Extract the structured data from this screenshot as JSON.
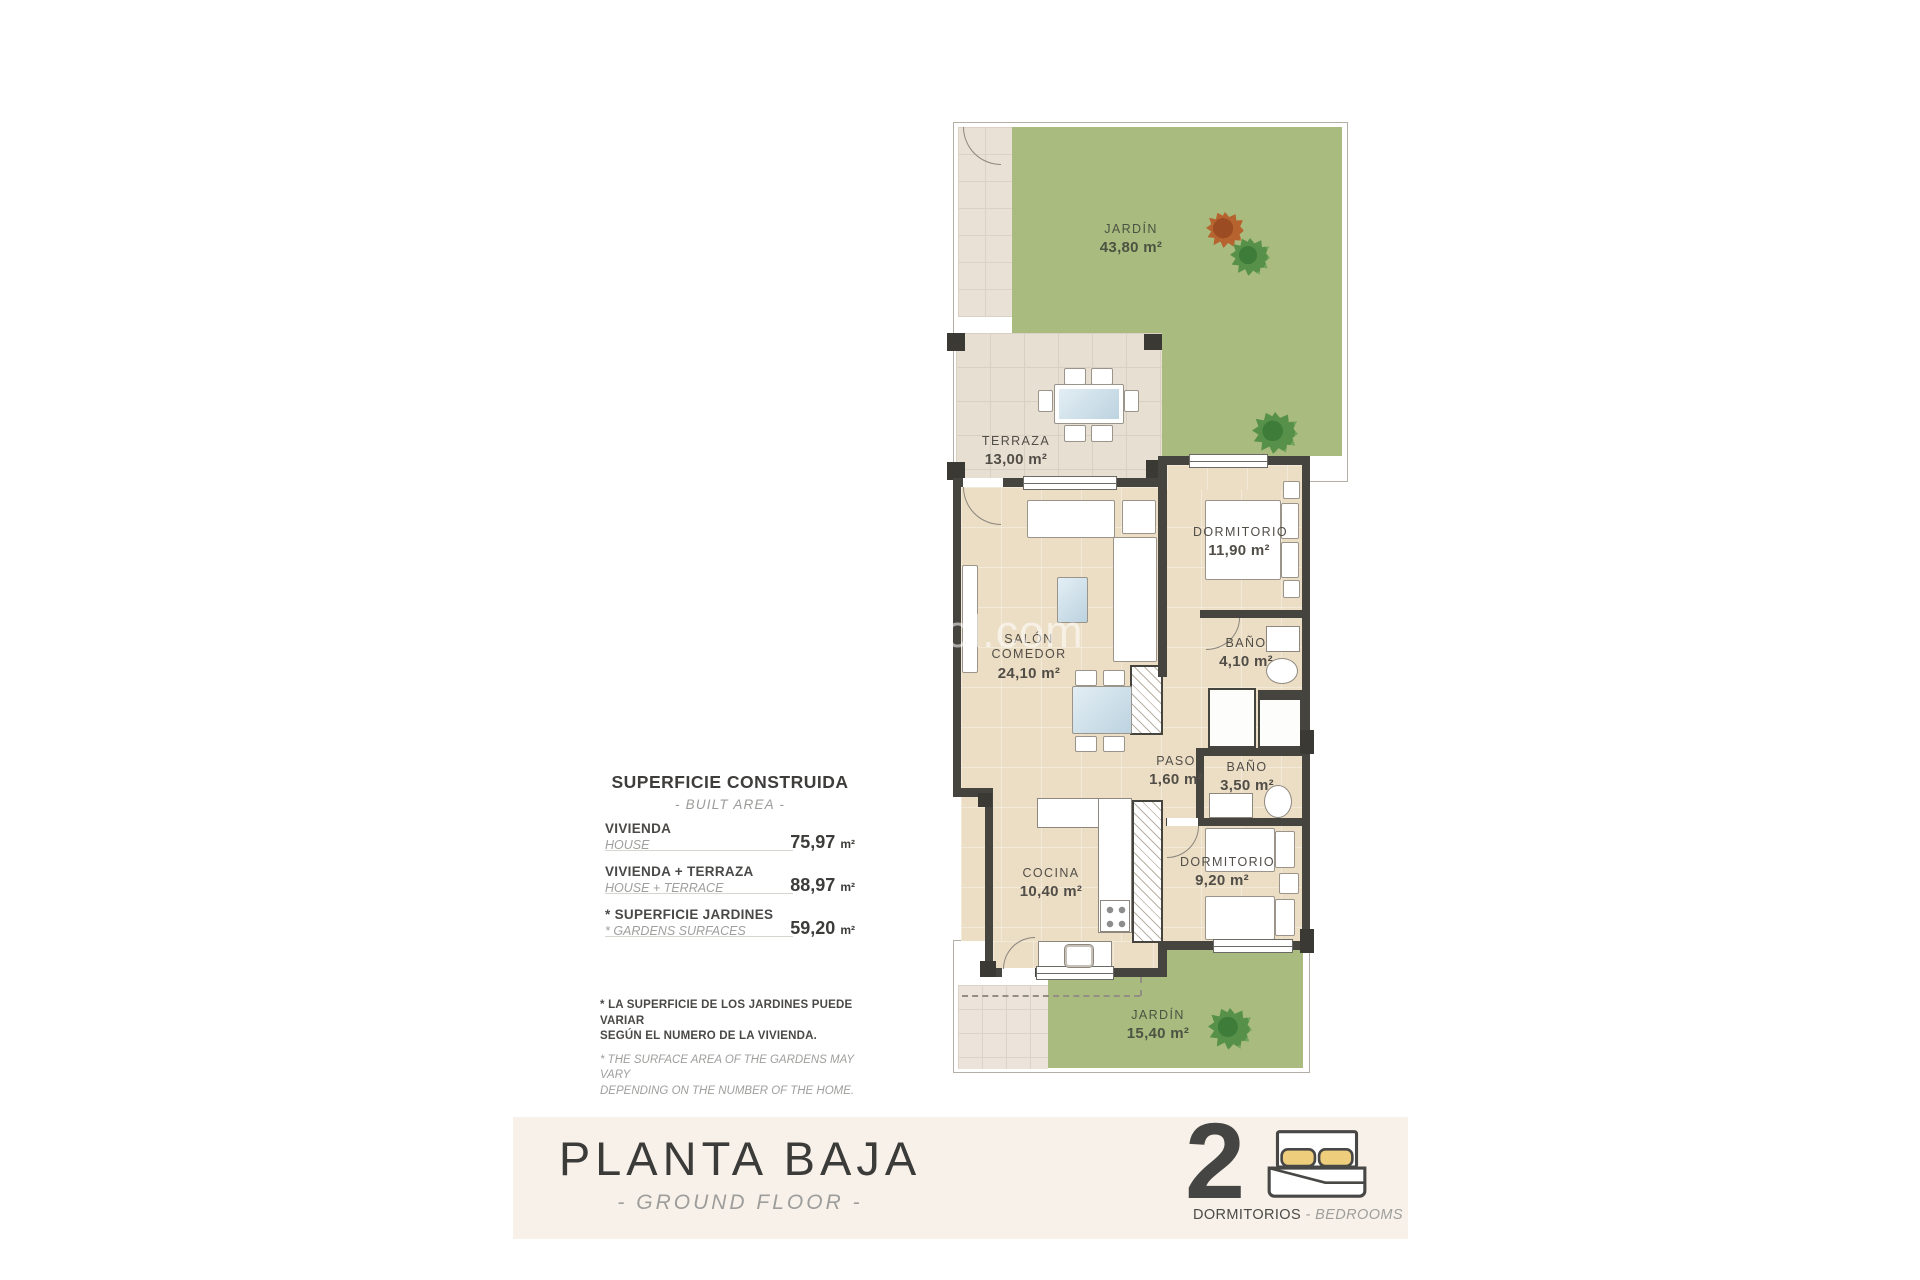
{
  "watermark": "sdesol.com",
  "rooms": {
    "jardin_top": {
      "name": "JARDÍN",
      "area": "43,80 m²"
    },
    "terraza": {
      "name": "TERRAZA",
      "area": "13,00 m²"
    },
    "salon": {
      "name": "SALÓN\nCOMEDOR",
      "area": "24,10 m²"
    },
    "dormitorio1": {
      "name": "DORMITORIO",
      "area": "11,90 m²"
    },
    "bano1": {
      "name": "BAÑO",
      "area": "4,10 m²"
    },
    "paso": {
      "name": "PASO",
      "area": "1,60 m²"
    },
    "bano2": {
      "name": "BAÑO",
      "area": "3,50 m²"
    },
    "cocina": {
      "name": "COCINA",
      "area": "10,40 m²"
    },
    "dormitorio2": {
      "name": "DORMITORIO",
      "area": "9,20 m²"
    },
    "jardin_bottom": {
      "name": "JARDÍN",
      "area": "15,40 m²"
    }
  },
  "info_panel": {
    "title": "SUPERFICIE CONSTRUIDA",
    "subtitle": "- BUILT AREA -",
    "rows": [
      {
        "label_es": "VIVIENDA",
        "label_en": "HOUSE",
        "value": "75,97",
        "unit": "m²"
      },
      {
        "label_es": "VIVIENDA + TERRAZA",
        "label_en": "HOUSE + TERRACE",
        "value": "88,97",
        "unit": "m²"
      },
      {
        "label_es": "* SUPERFICIE JARDINES",
        "label_en": "* GARDENS SURFACES",
        "value": "59,20",
        "unit": "m²"
      }
    ],
    "footnote_es": "* LA SUPERFICIE DE LOS JARDINES PUEDE VARIAR\nSEGÚN EL NUMERO DE LA VIVIENDA.",
    "footnote_en": "* THE SURFACE AREA OF THE GARDENS MAY VARY\nDEPENDING ON THE NUMBER OF THE HOME."
  },
  "banner": {
    "title": "PLANTA BAJA",
    "subtitle": "- GROUND FLOOR -",
    "bedrooms_count": "2",
    "bedrooms_label_es": "DORMITORIOS",
    "bedrooms_label_en": "- BEDROOMS"
  },
  "colors": {
    "garden_green": "#a9bb7e",
    "floor_tan": "#ecddc5",
    "terrace_tile": "#e8dfd3",
    "wall_dark": "#46443e",
    "banner_bg": "#f8f1e9",
    "text_dark": "#3b3b39",
    "text_gray": "#9d9d9b",
    "pillow_yellow": "#eecd7c"
  }
}
